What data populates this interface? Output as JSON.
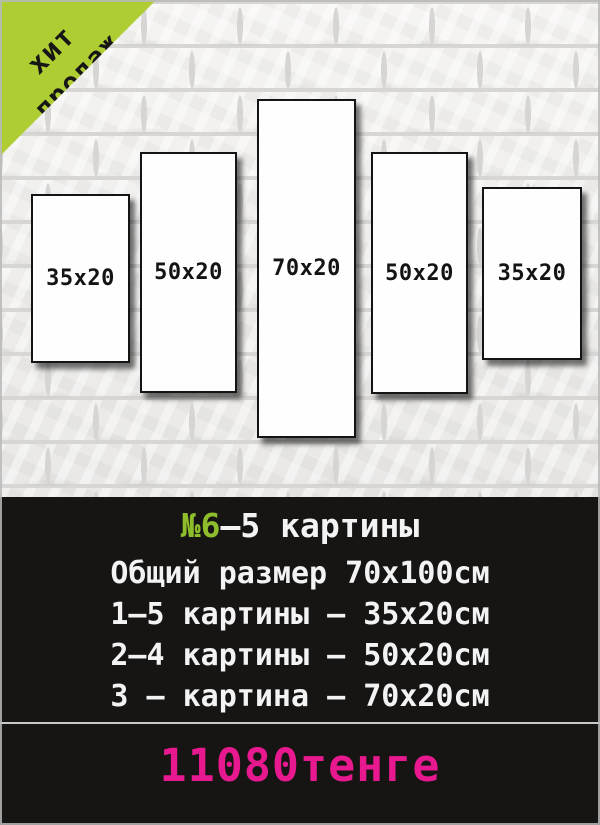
{
  "badge": {
    "line1": "хит",
    "line2": "продаж",
    "bg_color": "#aecd33",
    "text_color": "#161616"
  },
  "panels": [
    {
      "label": "35x20"
    },
    {
      "label": "50x20"
    },
    {
      "label": "70x20"
    },
    {
      "label": "50x20"
    },
    {
      "label": "35x20"
    }
  ],
  "info": {
    "set_number": "№6",
    "set_title_rest": "–5 картины",
    "lines": [
      "Общий размер 70x100см",
      "1–5 картины – 35x20см",
      "2–4 картины – 50x20см",
      "3 – картина – 70x20см"
    ],
    "price": "11080тенге",
    "accent_green": "#8dbd2b",
    "price_color": "#e8188f"
  }
}
